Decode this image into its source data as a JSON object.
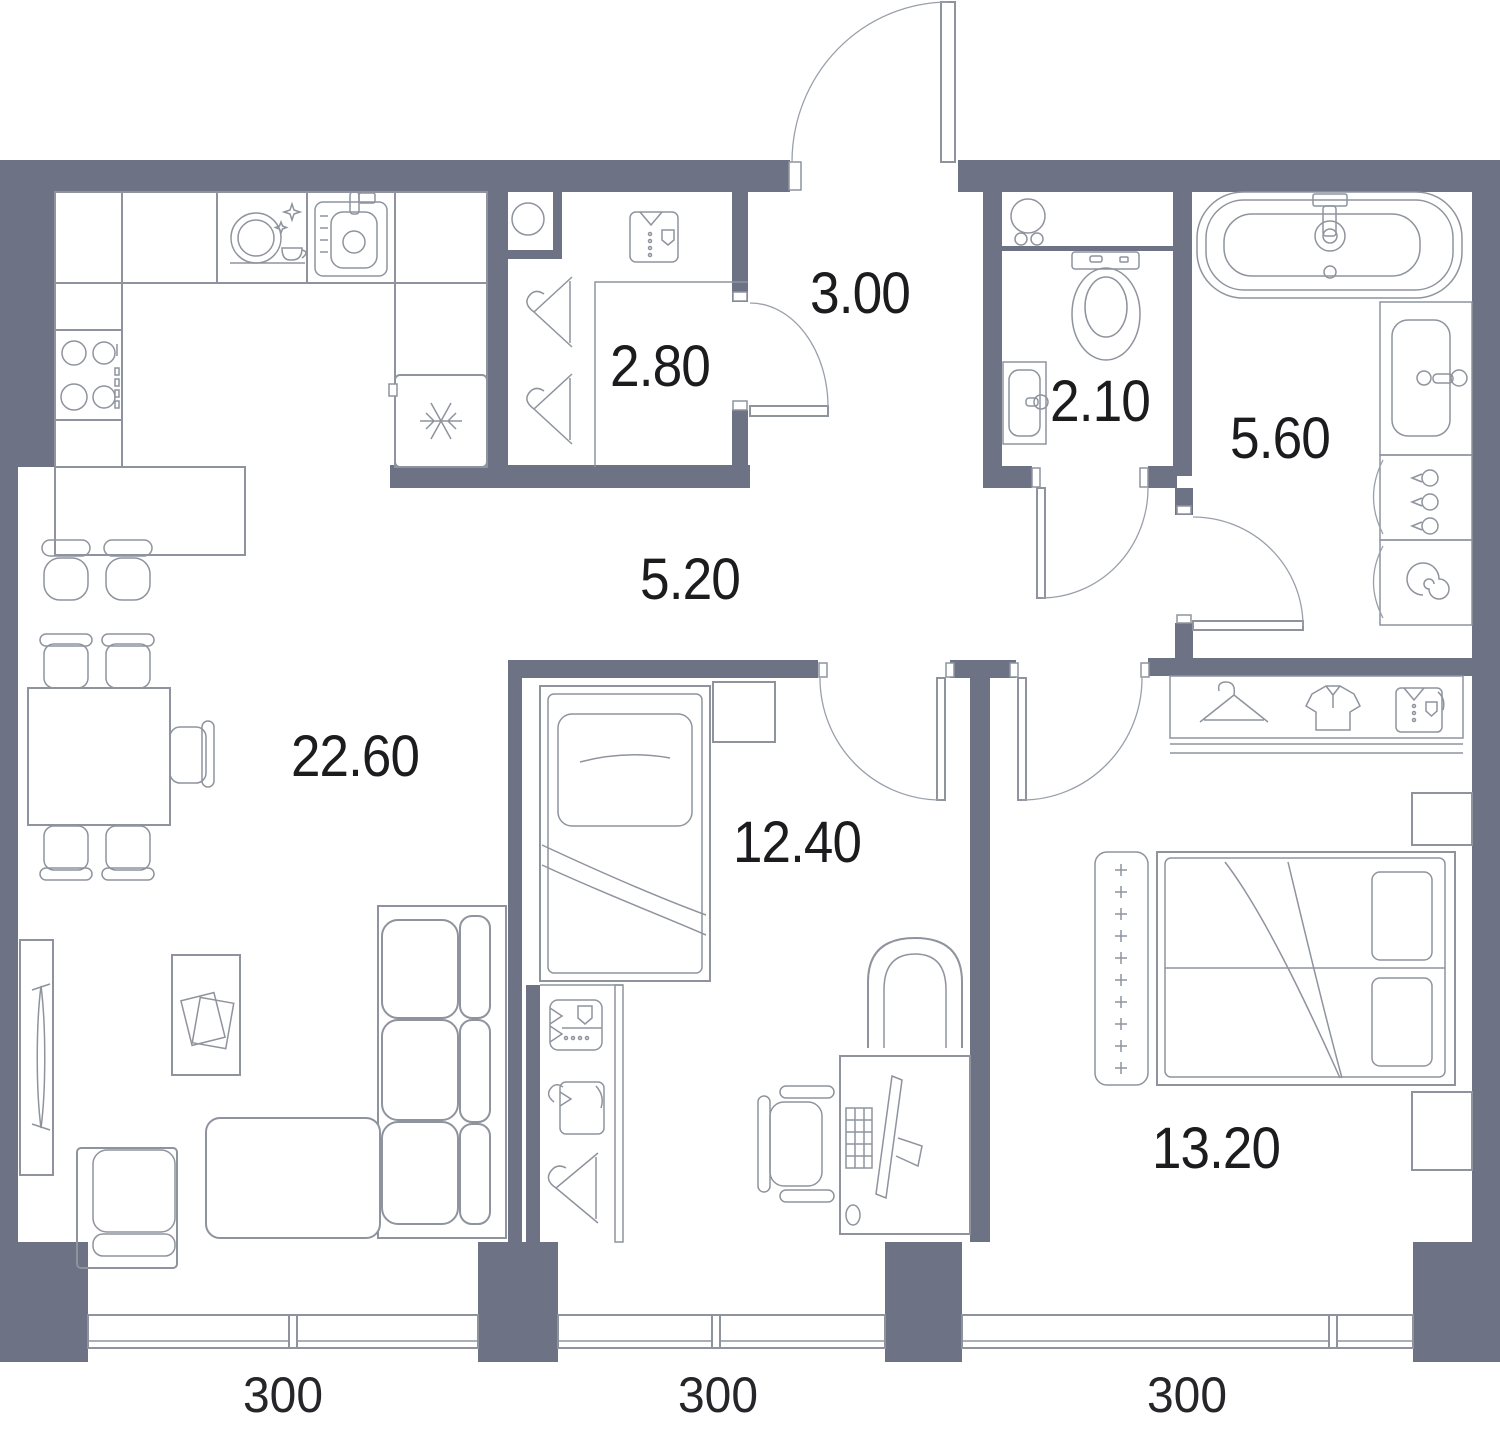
{
  "plan": {
    "rooms": {
      "wardrobe": {
        "area": "2.80"
      },
      "entry_hall": {
        "area": "3.00"
      },
      "wc": {
        "area": "2.10"
      },
      "bathroom": {
        "area": "5.60"
      },
      "hallway": {
        "area": "5.20"
      },
      "living_kitchen": {
        "area": "22.60"
      },
      "bedroom_small": {
        "area": "12.40"
      },
      "bedroom_large": {
        "area": "13.20"
      }
    },
    "window_dimensions": [
      "300",
      "300",
      "300"
    ],
    "colors": {
      "wall": "#6d7384",
      "furniture_line": "#8e939d",
      "label": "#1c1c1f",
      "background": "#ffffff"
    }
  }
}
